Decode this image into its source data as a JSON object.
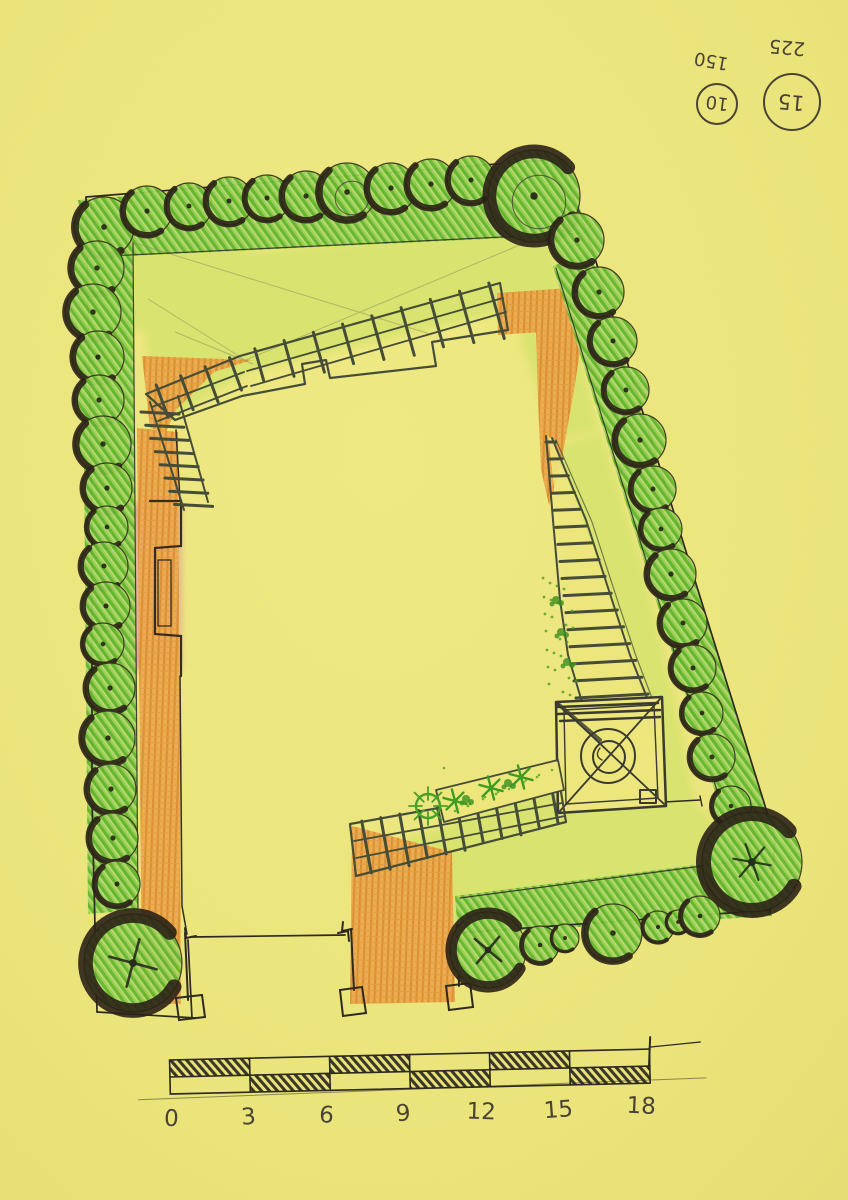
{
  "palette": {
    "paper": "#ece67c",
    "paper-light": "#f2ec8c",
    "grass": "#d8e36e",
    "hedge": "#7cc33e",
    "hedge-dark": "#5aad2a",
    "path-orange": "#eaa54b",
    "path-orange-dark": "#d8882c",
    "terrace-pink": "#dd9f8f",
    "ink": "#2d2920",
    "pen": "#454d38",
    "pen-brown": "#4a4336",
    "marker-shadow": "#2b2217",
    "plant-green": "#3f9b22"
  },
  "annotations": {
    "small_circle": {
      "label": "150",
      "value": "10"
    },
    "large_circle": {
      "label": "225",
      "value": "15"
    }
  },
  "scale_bar": {
    "ticks": [
      "0",
      "3",
      "6",
      "9",
      "12",
      "15",
      "18"
    ]
  },
  "plan": {
    "trees": [
      [
        104,
        227,
        30
      ],
      [
        147,
        211,
        25
      ],
      [
        189,
        206,
        23
      ],
      [
        229,
        201,
        24
      ],
      [
        267,
        198,
        23
      ],
      [
        306,
        196,
        25
      ],
      [
        347,
        192,
        29,
        "i"
      ],
      [
        391,
        188,
        25
      ],
      [
        431,
        184,
        25
      ],
      [
        471,
        180,
        24
      ],
      [
        534,
        196,
        46,
        "ib"
      ],
      [
        577,
        240,
        27
      ],
      [
        97,
        268,
        27
      ],
      [
        93,
        312,
        28
      ],
      [
        98,
        357,
        26
      ],
      [
        99,
        400,
        25
      ],
      [
        103,
        444,
        28
      ],
      [
        107,
        488,
        25
      ],
      [
        107,
        527,
        21
      ],
      [
        104,
        566,
        24
      ],
      [
        106,
        606,
        24
      ],
      [
        103,
        644,
        21
      ],
      [
        110,
        688,
        25
      ],
      [
        108,
        738,
        27
      ],
      [
        111,
        789,
        25
      ],
      [
        113,
        838,
        25
      ],
      [
        117,
        884,
        23
      ],
      [
        133,
        963,
        49,
        "pb"
      ],
      [
        599,
        292,
        25
      ],
      [
        613,
        341,
        24
      ],
      [
        626,
        390,
        23
      ],
      [
        640,
        440,
        26
      ],
      [
        653,
        489,
        23
      ],
      [
        661,
        529,
        21
      ],
      [
        671,
        574,
        25
      ],
      [
        683,
        623,
        24
      ],
      [
        693,
        668,
        23
      ],
      [
        702,
        713,
        21
      ],
      [
        712,
        757,
        23
      ],
      [
        731,
        806,
        20
      ],
      [
        752,
        862,
        50,
        "sb"
      ],
      [
        488,
        950,
        38,
        "xb"
      ],
      [
        540,
        945,
        19
      ],
      [
        565,
        938,
        14
      ],
      [
        613,
        933,
        29
      ],
      [
        658,
        927,
        16
      ],
      [
        678,
        922,
        12
      ],
      [
        700,
        916,
        20
      ]
    ],
    "starbursts": [
      [
        455,
        801
      ],
      [
        491,
        788
      ],
      [
        521,
        777
      ]
    ],
    "plant_circle": [
      428,
      806
    ],
    "leaf_blobs": [
      [
        556,
        600
      ],
      [
        561,
        632
      ],
      [
        567,
        662
      ],
      [
        466,
        799
      ],
      [
        508,
        783
      ]
    ]
  }
}
